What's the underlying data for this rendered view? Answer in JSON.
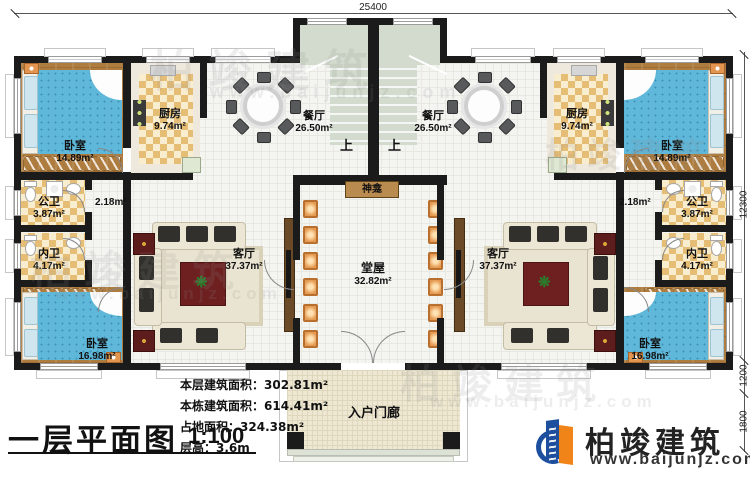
{
  "drawing": {
    "title": "一层平面图",
    "scale": "1:100"
  },
  "stats": {
    "line1_label": "本层建筑面积：",
    "line1_value": "302.81m²",
    "line2_label": "本栋建筑面积：",
    "line2_value": "614.41m²",
    "line3_label": "占地面积：",
    "line3_value": "324.38m²",
    "line4_label": "层高：",
    "line4_value": "3.6m"
  },
  "dimensions": {
    "top_width": "25400",
    "right_total": "12300",
    "right_seg_a": "1200",
    "right_seg_b": "1800"
  },
  "rooms": {
    "bedroom_top": {
      "name": "卧室",
      "area": "14.89m²"
    },
    "bedroom_bottom": {
      "name": "卧室",
      "area": "16.98m²"
    },
    "kitchen": {
      "name": "厨房",
      "area": "9.74m²"
    },
    "dining": {
      "name": "餐厅",
      "area": "26.50m²"
    },
    "living": {
      "name": "客厅",
      "area": "37.37m²"
    },
    "hall": {
      "name": "堂屋",
      "area": "32.82m²"
    },
    "public_bath": {
      "name": "公卫",
      "area": "3.87m²"
    },
    "private_bath": {
      "name": "内卫",
      "area": "4.17m²"
    },
    "corridor_area": "2.18m²",
    "shrine": "神龛",
    "porch": "入户门廊",
    "stairs_up": "上"
  },
  "brand": {
    "name": "柏竣建筑",
    "url": "www.baijunjz.com",
    "blue": "#1e4f9e",
    "orange": "#f08418"
  },
  "colors": {
    "wall": "#1b1b1b",
    "wood_floor": "#ad7c3e",
    "bed_blue": "#5fb7d9",
    "stair_green": "#d2dbcd",
    "checker_tan": "#e6bd75"
  }
}
